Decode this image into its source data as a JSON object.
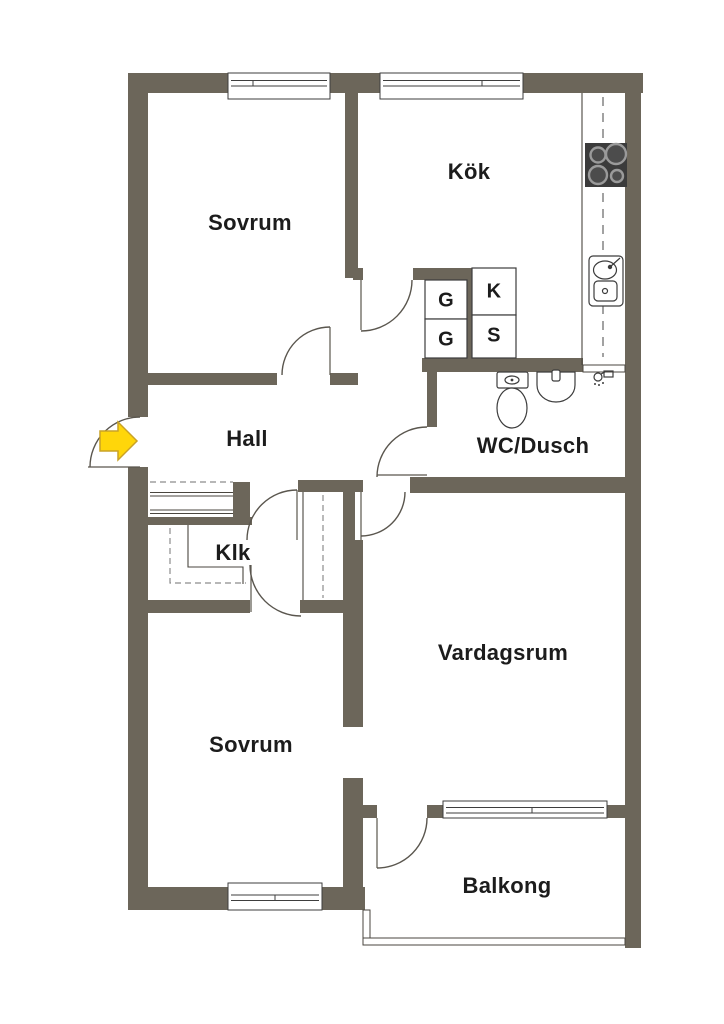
{
  "rooms": [
    {
      "id": "sovrum-top",
      "label": "Sovrum"
    },
    {
      "id": "kok",
      "label": "Kök"
    },
    {
      "id": "hall",
      "label": "Hall"
    },
    {
      "id": "wc-dusch",
      "label": "WC/Dusch"
    },
    {
      "id": "klk",
      "label": "Klk"
    },
    {
      "id": "vardagsrum",
      "label": "Vardagsrum"
    },
    {
      "id": "sovrum-bottom",
      "label": "Sovrum"
    },
    {
      "id": "balkong",
      "label": "Balkong"
    }
  ],
  "cabinets": [
    {
      "id": "cabinet-g1",
      "label": "G"
    },
    {
      "id": "cabinet-g2",
      "label": "G"
    },
    {
      "id": "cabinet-k",
      "label": "K"
    },
    {
      "id": "cabinet-s",
      "label": "S"
    }
  ],
  "fixtures": [
    "entrance-arrow",
    "stove",
    "kitchen-sink",
    "toilet",
    "wash-basin",
    "shower"
  ],
  "colors": {
    "wall": "#6C665A",
    "background": "#FFFFFF",
    "text": "#1C1C1C",
    "arrow_fill": "#FFD60A",
    "arrow_stroke": "#C9A227",
    "stove_fill": "#3B3B3B"
  }
}
